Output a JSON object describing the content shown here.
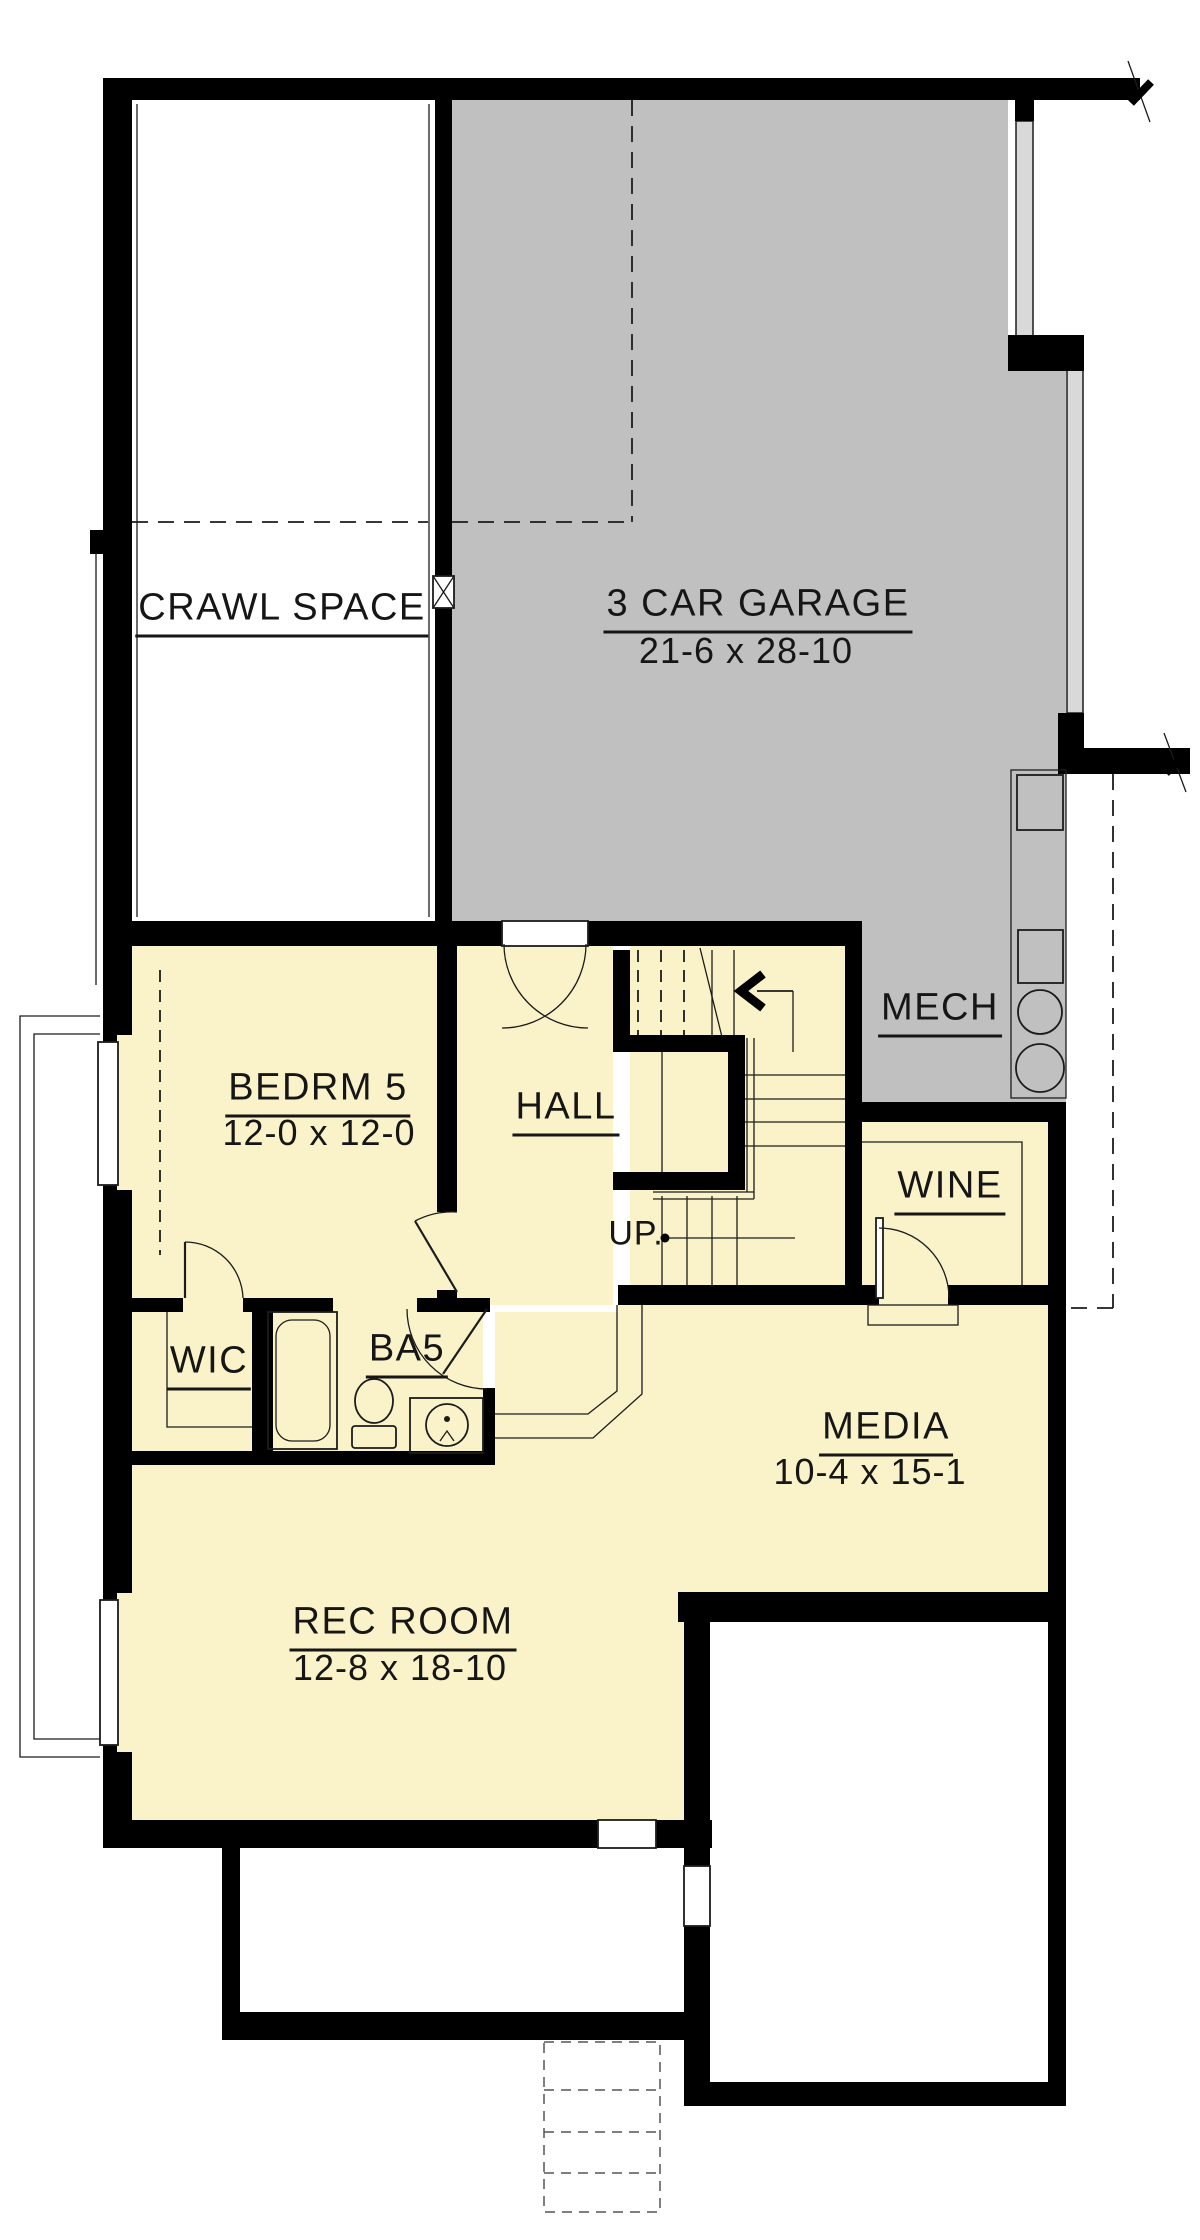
{
  "colors": {
    "room_fill": "#FAF3C9",
    "garage_fill": "#C1C0C0",
    "band_fill": "#D9D9D9",
    "wall": "#000000",
    "line": "#1C1C1C"
  },
  "rooms": {
    "crawl_space": {
      "label": "CRAWL SPACE"
    },
    "garage": {
      "label": "3 CAR GARAGE",
      "dim": "21-6 x 28-10"
    },
    "bedroom5": {
      "label": "BEDRM 5",
      "dim": "12-0 x 12-0"
    },
    "hall": {
      "label": "HALL"
    },
    "mech": {
      "label": "MECH"
    },
    "wine": {
      "label": "WINE"
    },
    "wic": {
      "label": "WIC"
    },
    "bath5": {
      "label": "BA5"
    },
    "media": {
      "label": "MEDIA",
      "dim": "10-4 x 15-1"
    },
    "rec_room": {
      "label": "REC ROOM",
      "dim": "12-8 x 18-10"
    }
  },
  "stairs": {
    "direction_label": "UP."
  }
}
